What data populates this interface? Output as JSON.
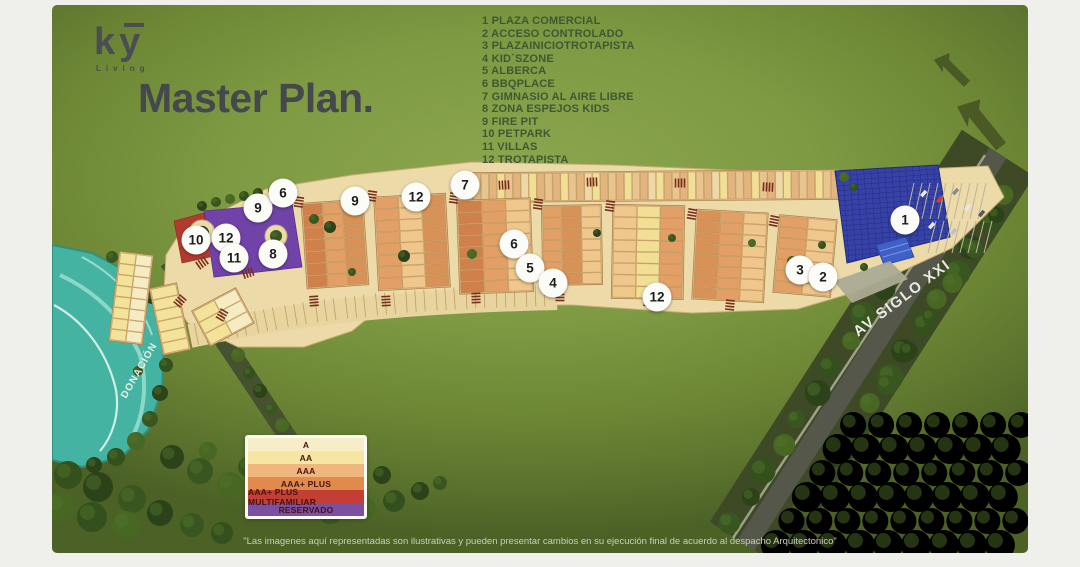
{
  "logo": {
    "text": "ky",
    "subtext": "Living"
  },
  "title": "Master Plan.",
  "poi_list": {
    "items": [
      {
        "n": "1",
        "label": "PLAZA COMERCIAL"
      },
      {
        "n": "2",
        "label": "ACCESO CONTROLADO"
      },
      {
        "n": "3",
        "label": "PLAZAINICIOTROTAPISTA"
      },
      {
        "n": "4",
        "label": "KID´SZONE"
      },
      {
        "n": "5",
        "label": "ALBERCA"
      },
      {
        "n": "6",
        "label": "BBQPLACE"
      },
      {
        "n": "7",
        "label": "GIMNASIO AL AIRE LIBRE"
      },
      {
        "n": "8",
        "label": "ZONA ESPEJOS KIDS"
      },
      {
        "n": "9",
        "label": "FIRE PIT"
      },
      {
        "n": "10",
        "label": "PETPARK"
      },
      {
        "n": "11",
        "label": "VILLAS"
      },
      {
        "n": "12",
        "label": "TROTAPISTA"
      }
    ]
  },
  "map": {
    "markers": [
      {
        "n": "10",
        "x": 144,
        "y": 235
      },
      {
        "n": "12",
        "x": 174,
        "y": 233
      },
      {
        "n": "11",
        "x": 182,
        "y": 253
      },
      {
        "n": "8",
        "x": 221,
        "y": 249
      },
      {
        "n": "9",
        "x": 206,
        "y": 203
      },
      {
        "n": "6",
        "x": 231,
        "y": 188
      },
      {
        "n": "9",
        "x": 303,
        "y": 196
      },
      {
        "n": "12",
        "x": 364,
        "y": 192
      },
      {
        "n": "7",
        "x": 413,
        "y": 180
      },
      {
        "n": "6",
        "x": 462,
        "y": 239
      },
      {
        "n": "5",
        "x": 478,
        "y": 263
      },
      {
        "n": "4",
        "x": 501,
        "y": 278
      },
      {
        "n": "12",
        "x": 605,
        "y": 292
      },
      {
        "n": "3",
        "x": 748,
        "y": 265
      },
      {
        "n": "2",
        "x": 771,
        "y": 272
      },
      {
        "n": "1",
        "x": 853,
        "y": 215
      }
    ],
    "road_labels": [
      {
        "text": "AV SIGLO XXI",
        "x": 806,
        "y": 332,
        "rot": -37,
        "size": 15,
        "ls": 1.5
      },
      {
        "text": "DONACIÓN",
        "x": 74,
        "y": 394,
        "rot": -60,
        "size": 10,
        "ls": 1
      }
    ]
  },
  "legend": {
    "items": [
      {
        "label": "A",
        "color": "#F8EDC9"
      },
      {
        "label": "AA",
        "color": "#F6E6A2"
      },
      {
        "label": "AAA",
        "color": "#EFB67E"
      },
      {
        "label": "AAA+ PLUS",
        "color": "#E08B4C"
      },
      {
        "label": "AAA+ PLUS MULTIFAMILIAR",
        "color": "#C33F35"
      },
      {
        "label": "RESERVADO",
        "color": "#7C4FA0"
      }
    ]
  },
  "disclaimer": "\"Las imagenes aquí representadas son ilustrativas y pueden presentar cambios en su ejecución final de acuerdo al despacho Arquitectonico\""
}
